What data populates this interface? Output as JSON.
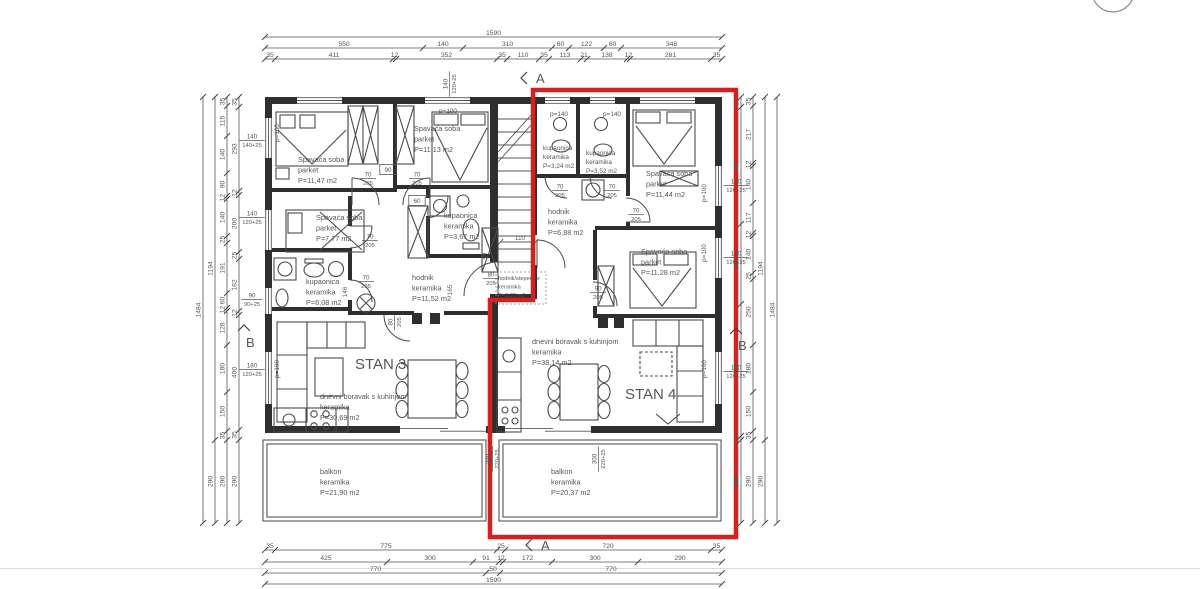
{
  "plan": {
    "red_color": "#d42020",
    "stan_labels": [
      {
        "t": "STAN 3",
        "x": 355,
        "y": 369
      },
      {
        "t": "STAN 4",
        "x": 625,
        "y": 399
      }
    ],
    "rooms": [
      {
        "x": 298,
        "y": 162,
        "lines": [
          "Spavaća soba",
          "parket",
          "P=11,47 m2"
        ]
      },
      {
        "x": 414,
        "y": 131,
        "lines": [
          "Spavaća soba",
          "parket",
          "P=11,13 m2"
        ]
      },
      {
        "x": 316,
        "y": 220,
        "lines": [
          "Spavaća soba",
          "parket",
          "P=7,77 m2"
        ]
      },
      {
        "x": 444,
        "y": 218,
        "lines": [
          "kupaonica",
          "keramika",
          "P=3,67 m2"
        ]
      },
      {
        "x": 306,
        "y": 284,
        "lines": [
          "kupaonica",
          "keramika",
          "P=6,08 m2"
        ]
      },
      {
        "x": 412,
        "y": 280,
        "lines": [
          "hodnik",
          "keramika",
          "P=11,52 m2"
        ]
      },
      {
        "x": 498,
        "y": 280,
        "lines": [
          "hodnik/stepenice",
          "keramika",
          "P=3,32 m2"
        ],
        "size": 5.6,
        "lh": 8.5
      },
      {
        "x": 543,
        "y": 150,
        "lines": [
          "kupaonica",
          "keramika",
          "P=3,24 m2"
        ],
        "size": 6.4,
        "lh": 9
      },
      {
        "x": 586,
        "y": 155,
        "lines": [
          "kupaonica",
          "keramika",
          "P=3,52 m2"
        ],
        "size": 6.4,
        "lh": 9
      },
      {
        "x": 646,
        "y": 176,
        "lines": [
          "Spavaća soba",
          "parket",
          "P=11,44 m2"
        ]
      },
      {
        "x": 548,
        "y": 214,
        "lines": [
          "hodnik",
          "keramika",
          "P=6,88 m2"
        ]
      },
      {
        "x": 641,
        "y": 254,
        "lines": [
          "Spavaća soba",
          "parket",
          "P=11,28 m2"
        ]
      },
      {
        "x": 320,
        "y": 399,
        "lines": [
          "dnevni boravak s kuhinjom",
          "keramika",
          "P=30,69 m2"
        ]
      },
      {
        "x": 532,
        "y": 344,
        "lines": [
          "dnevni boravak s kuhinjom",
          "keramika",
          "P=38,14 m2"
        ]
      },
      {
        "x": 320,
        "y": 474,
        "lines": [
          "balkon",
          "keramika",
          "P=21,90 m2"
        ]
      },
      {
        "x": 551,
        "y": 474,
        "lines": [
          "balkon",
          "keramika",
          "P=20,37 m2"
        ]
      }
    ],
    "dim_chains": [
      {
        "o": "h",
        "p": 37,
        "b": [
          265,
          722
        ],
        "v": [
          "1590"
        ]
      },
      {
        "o": "h",
        "p": 48,
        "b": [
          265,
          423,
          463,
          552,
          569,
          604,
          621,
          722
        ],
        "v": [
          "550",
          "140",
          "310",
          "60",
          "122",
          "60",
          "348"
        ]
      },
      {
        "o": "h",
        "p": 59,
        "b": [
          265,
          275,
          393,
          396,
          497,
          507,
          539,
          549,
          581,
          587,
          627,
          630,
          711,
          722
        ],
        "v": [
          "35",
          "411",
          "12",
          "352",
          "35",
          "110",
          "35",
          "113",
          "21",
          "138",
          "12",
          "281",
          "35"
        ]
      },
      {
        "o": "h",
        "p": 550,
        "b": [
          265,
          275,
          497,
          505,
          711,
          722
        ],
        "v": [
          "35",
          "775",
          "25",
          "720",
          "35"
        ]
      },
      {
        "o": "h",
        "p": 562,
        "b": [
          265,
          387,
          473,
          499,
          503,
          552,
          638,
          722
        ],
        "v": [
          "425",
          "300",
          "91",
          "12",
          "172",
          "300",
          "290"
        ]
      },
      {
        "o": "h",
        "p": 573,
        "b": [
          265,
          486,
          500,
          722
        ],
        "v": [
          "770",
          "50",
          "770"
        ]
      },
      {
        "o": "h",
        "p": 584,
        "b": [
          265,
          722
        ],
        "v": [
          "1590"
        ]
      },
      {
        "o": "v",
        "p": 203,
        "b": [
          97,
          523
        ],
        "v": [
          "1484"
        ]
      },
      {
        "o": "v",
        "p": 215,
        "b": [
          97,
          440,
          523
        ],
        "v": [
          "1194",
          "290"
        ]
      },
      {
        "o": "v",
        "p": 227,
        "b": [
          97,
          106,
          136,
          173,
          196,
          199,
          236,
          243,
          293,
          308,
          311,
          345,
          392,
          431,
          440,
          523
        ],
        "v": [
          "35",
          "115",
          "140",
          "90",
          "12",
          "140",
          "25",
          "191",
          "60",
          "12",
          "128",
          "180",
          "150",
          "35",
          "290"
        ]
      },
      {
        "o": "v",
        "p": 239,
        "b": [
          97,
          107,
          191,
          195,
          252,
          259,
          311,
          315,
          430,
          440,
          523
        ],
        "v": [
          "35",
          "293",
          "12",
          "200",
          "25",
          "182",
          "12",
          "400",
          "35",
          "290"
        ]
      },
      {
        "o": "v",
        "p": 741,
        "b": [
          97,
          107,
          224,
          304,
          436,
          440,
          523
        ],
        "v": [
          "35",
          "407",
          "280",
          "460",
          "35",
          "290"
        ]
      },
      {
        "o": "v",
        "p": 753,
        "b": [
          97,
          106,
          163,
          166,
          203,
          233,
          236,
          273,
          279,
          345,
          392,
          431,
          440,
          523
        ],
        "v": [
          "35",
          "217",
          "12",
          "140",
          "117",
          "12",
          "140",
          "25",
          "250",
          "180",
          "150",
          "35",
          "290"
        ]
      },
      {
        "o": "v",
        "p": 765,
        "b": [
          97,
          440,
          523
        ],
        "v": [
          "1194",
          "290"
        ]
      },
      {
        "o": "v",
        "p": 777,
        "b": [
          97,
          523
        ],
        "v": [
          "1484"
        ]
      }
    ],
    "fraction_labels": [
      {
        "top": "140",
        "bot": "140+25",
        "x": 252,
        "y": 140,
        "rot": 0
      },
      {
        "top": "140",
        "bot": "120+25",
        "x": 252,
        "y": 217,
        "rot": 0
      },
      {
        "top": "90",
        "bot": "90+25",
        "x": 252,
        "y": 299,
        "rot": 0
      },
      {
        "top": "180",
        "bot": "120+25",
        "x": 252,
        "y": 369,
        "rot": 0
      },
      {
        "top": "140",
        "bot": "120+25",
        "x": 736,
        "y": 185,
        "rot": 0
      },
      {
        "top": "140",
        "bot": "120+25",
        "x": 736,
        "y": 257,
        "rot": 0
      },
      {
        "top": "180",
        "bot": "120+25",
        "x": 736,
        "y": 371,
        "rot": 0
      },
      {
        "top": "140",
        "bot": "120+25",
        "x": 449,
        "y": 84,
        "rot": -90
      },
      {
        "top": "300",
        "bot": "220+25",
        "x": 492,
        "y": 459,
        "rot": -90
      },
      {
        "top": "300",
        "bot": "220+25",
        "x": 598,
        "y": 459,
        "rot": -90
      },
      {
        "top": "70",
        "bot": "205",
        "x": 368,
        "y": 178,
        "rot": 0
      },
      {
        "top": "70",
        "bot": "205",
        "x": 417,
        "y": 178,
        "rot": 0
      },
      {
        "top": "70",
        "bot": "205",
        "x": 370,
        "y": 240,
        "rot": 0
      },
      {
        "top": "70",
        "bot": "205",
        "x": 366,
        "y": 281,
        "rot": 0
      },
      {
        "top": "80",
        "bot": "205",
        "x": 394,
        "y": 322,
        "rot": -90
      },
      {
        "top": "80",
        "bot": "205",
        "x": 491,
        "y": 278,
        "rot": 0
      },
      {
        "top": "70",
        "bot": "205",
        "x": 560,
        "y": 190,
        "rot": 0
      },
      {
        "top": "70",
        "bot": "205",
        "x": 612,
        "y": 190,
        "rot": 0
      },
      {
        "top": "70",
        "bot": "205",
        "x": 636,
        "y": 214,
        "rot": 0
      },
      {
        "top": "90",
        "bot": "205",
        "x": 598,
        "y": 292,
        "rot": 0
      }
    ],
    "plain_labels": [
      {
        "t": "90",
        "x": 388,
        "y": 172,
        "box": true
      },
      {
        "t": "60",
        "x": 417,
        "y": 203,
        "box": true
      },
      {
        "t": "110",
        "x": 520,
        "y": 240
      },
      {
        "t": "165",
        "x": 452,
        "y": 290,
        "rot": -90
      },
      {
        "t": "146",
        "x": 347,
        "y": 292,
        "rot": -90
      },
      {
        "t": "44",
        "x": 486,
        "y": 256,
        "rot": -90
      },
      {
        "t": "p=100",
        "x": 448,
        "y": 113
      },
      {
        "t": "p=140",
        "x": 559,
        "y": 116
      },
      {
        "t": "p=140",
        "x": 612,
        "y": 116
      },
      {
        "t": "p=100",
        "x": 279,
        "y": 133,
        "rot": -90
      },
      {
        "t": "p=100",
        "x": 279,
        "y": 369,
        "rot": -90
      },
      {
        "t": "p=100",
        "x": 706,
        "y": 193,
        "rot": -90
      },
      {
        "t": "p=100",
        "x": 706,
        "y": 253,
        "rot": -90
      },
      {
        "t": "p=100",
        "x": 706,
        "y": 369,
        "rot": -90
      }
    ],
    "markers": [
      {
        "t": "A",
        "x": 536,
        "y": 79,
        "kind": "left"
      },
      {
        "t": "A",
        "x": 541,
        "y": 546,
        "kind": "left"
      },
      {
        "t": "B",
        "x": 246,
        "y": 343,
        "kind": "up"
      },
      {
        "t": "B",
        "x": 738,
        "y": 346,
        "kind": "up"
      }
    ]
  }
}
